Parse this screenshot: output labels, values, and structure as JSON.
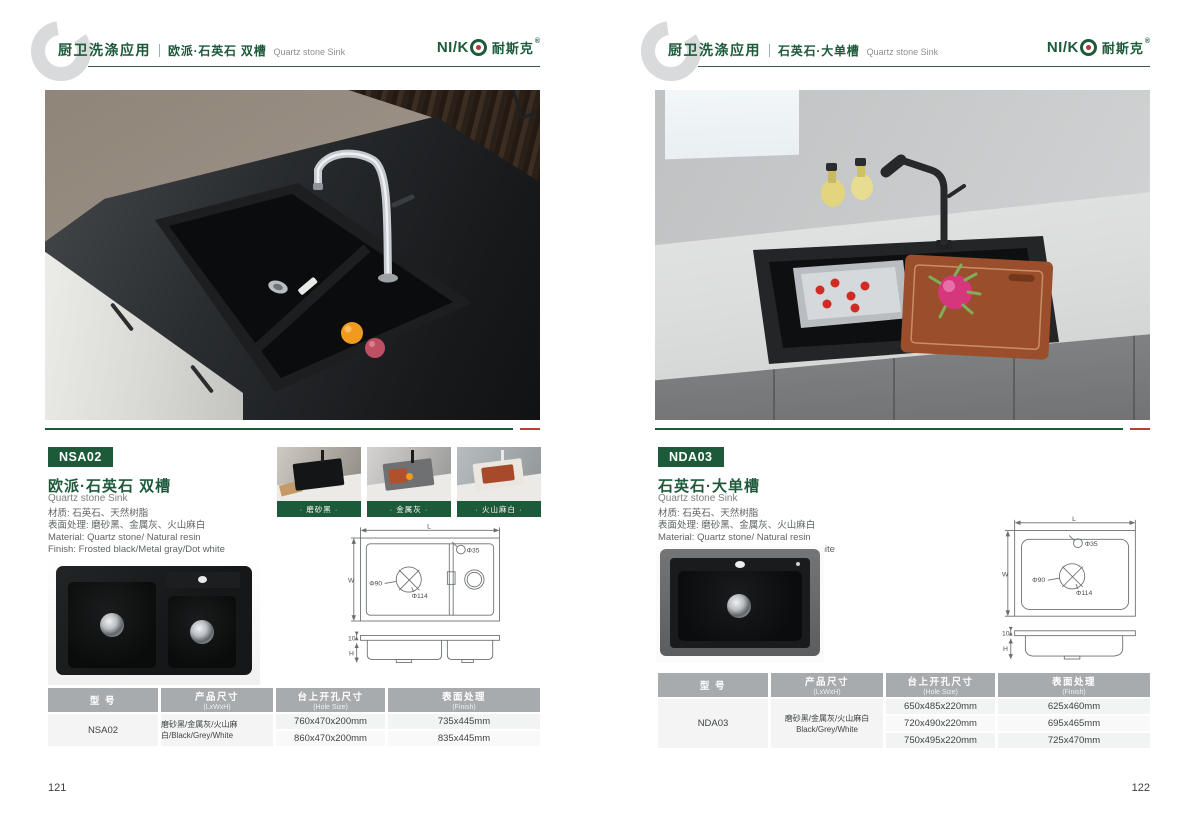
{
  "brand": {
    "name_stylized": "NI/K",
    "cn": "耐斯克",
    "reg": "®"
  },
  "pages": [
    {
      "page_number": "121",
      "header": {
        "category": "厨卫洗涤应用",
        "title": "欧派·石英石 双槽",
        "subtitle": "Quartz stone Sink"
      },
      "info": {
        "model": "NSA02",
        "title_cn": "欧派·石英石 双槽",
        "title_en": "Quartz stone Sink",
        "lines": [
          "材质: 石英石、天然树脂",
          "表面处理: 磨砂黑、金属灰、火山麻白",
          "Material: Quartz stone/ Natural resin",
          "Finish: Frosted black/Metal gray/Dot white"
        ]
      },
      "swatches": [
        {
          "label": "· 磨砂黑 ·"
        },
        {
          "label": "· 金属灰 ·"
        },
        {
          "label": "· 火山麻白 ·"
        }
      ],
      "drawing": {
        "L": "L",
        "W": "W",
        "H": "H",
        "hole": "Φ35",
        "drain_inner": "Φ90",
        "drain_outer": "Φ114",
        "lip": "10"
      },
      "table": {
        "headers": [
          {
            "cn": "型 号",
            "en": ""
          },
          {
            "cn": "产品尺寸",
            "en": "(LxWxH)"
          },
          {
            "cn": "台上开孔尺寸",
            "en": "(Hole Size)"
          },
          {
            "cn": "表面处理",
            "en": "(Finish)"
          }
        ],
        "model": "NSA02",
        "rows": [
          {
            "size": "760x470x200mm",
            "hole": "735x445mm"
          },
          {
            "size": "860x470x200mm",
            "hole": "835x445mm"
          }
        ],
        "finish": "磨砂黑/金属灰/火山麻白/Black/Grey/White"
      }
    },
    {
      "page_number": "122",
      "header": {
        "category": "厨卫洗涤应用",
        "title": "石英石·大单槽",
        "subtitle": "Quartz stone Sink"
      },
      "info": {
        "model": "NDA03",
        "title_cn": "石英石·大单槽",
        "title_en": "Quartz stone Sink",
        "lines": [
          "材质: 石英石、天然树脂",
          "表面处理: 磨砂黑、金属灰、火山麻白",
          "Material: Quartz stone/ Natural resin",
          "Finish: Frosted black/Metal gray/Dot white"
        ]
      },
      "drawing": {
        "L": "L",
        "W": "W",
        "H": "H",
        "hole": "Φ35",
        "drain_inner": "Φ90",
        "drain_outer": "Φ114",
        "lip": "10"
      },
      "table": {
        "headers": [
          {
            "cn": "型 号",
            "en": ""
          },
          {
            "cn": "产品尺寸",
            "en": "(LxWxH)"
          },
          {
            "cn": "台上开孔尺寸",
            "en": "(Hole Size)"
          },
          {
            "cn": "表面处理",
            "en": "(Finish)"
          }
        ],
        "model": "NDA03",
        "rows": [
          {
            "size": "650x485x220mm",
            "hole": "625x460mm"
          },
          {
            "size": "720x490x220mm",
            "hole": "695x465mm"
          },
          {
            "size": "750x495x220mm",
            "hole": "725x470mm"
          }
        ],
        "finish_line1": "磨砂黑/金属灰/火山麻白",
        "finish_line2": "Black/Grey/White"
      }
    }
  ]
}
